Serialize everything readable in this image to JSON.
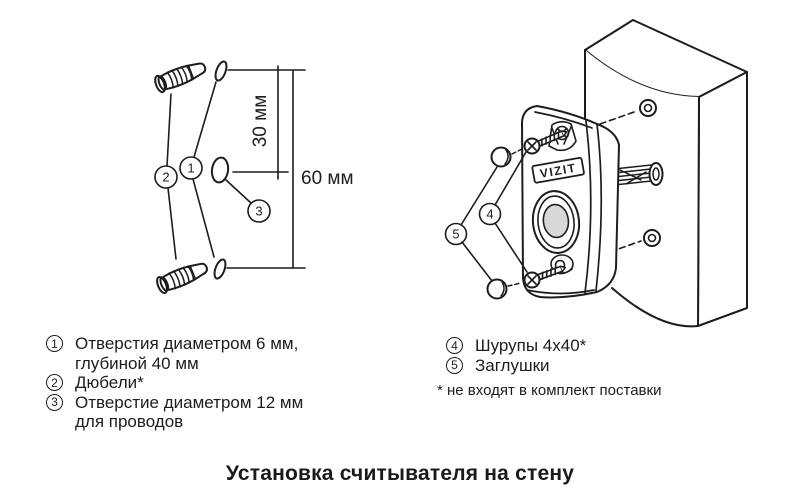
{
  "title": "Установка считывателя на стену",
  "diagram_left": {
    "dim_small": "30 мм",
    "dim_large": "60 мм",
    "callout_1": "1",
    "callout_2": "2",
    "callout_3": "3"
  },
  "diagram_right": {
    "brand": "VIZIT",
    "callout_4": "4",
    "callout_5": "5"
  },
  "legend_left": {
    "items": [
      {
        "num": "1",
        "lines": [
          "Отверстия диаметром 6 мм,",
          "глубиной 40 мм"
        ]
      },
      {
        "num": "2",
        "lines": [
          "Дюбели*"
        ]
      },
      {
        "num": "3",
        "lines": [
          "Отверстие диаметром 12 мм",
          "для проводов"
        ]
      }
    ]
  },
  "legend_right": {
    "items": [
      {
        "num": "4",
        "lines": [
          "Шурупы 4x40*"
        ]
      },
      {
        "num": "5",
        "lines": [
          "Заглушки"
        ]
      }
    ],
    "footnote": "* не входят в комплект поставки"
  },
  "colors": {
    "line": "#1d1d1d",
    "button_fill": "#d8d8d8",
    "background": "#ffffff"
  }
}
